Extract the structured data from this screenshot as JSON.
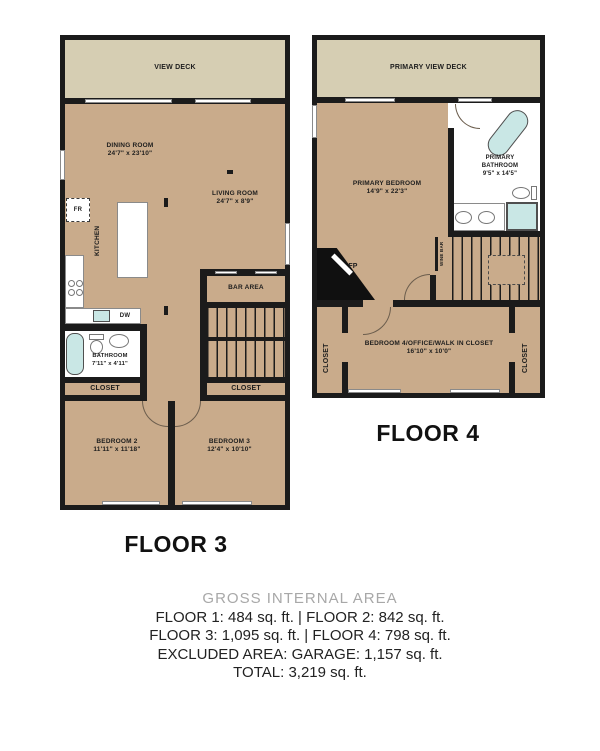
{
  "colors": {
    "wall": "#1b1b1b",
    "floor": "#c9ab8b",
    "deck": "#d6ceb3",
    "fixture_blue": "#c9e7e5",
    "muted_heading": "#a8a8a8"
  },
  "floor3": {
    "title": "FLOOR 3",
    "deck_label": "VIEW DECK",
    "dining": {
      "name": "DINING ROOM",
      "dims": "24'7\" x 23'10\""
    },
    "living": {
      "name": "LIVING ROOM",
      "dims": "24'7\" x 8'9\""
    },
    "kitchen_label": "KITCHEN",
    "fridge_label": "FR",
    "dishwasher_label": "DW",
    "bar_label": "BAR AREA",
    "bathroom": {
      "name": "BATHROOM",
      "dims": "7'11\" x 4'11\""
    },
    "closet_left_label": "CLOSET",
    "closet_right_label": "CLOSET",
    "bedroom2": {
      "name": "BEDROOM 2",
      "dims": "11'11\" x 11'18\""
    },
    "bedroom3": {
      "name": "BEDROOM 3",
      "dims": "12'4\" x 10'10\""
    }
  },
  "floor4": {
    "title": "FLOOR 4",
    "deck_label": "PRIMARY VIEW DECK",
    "primary_bedroom": {
      "name": "PRIMARY BEDROOM",
      "dims": "14'9\" x 22'3\""
    },
    "primary_bathroom": {
      "line1": "PRIMARY",
      "line2": "BATHROOM",
      "dims": "9'5\" x 14'5\""
    },
    "wine_bar_label": "WINE BAR",
    "fireplace_label": "FP",
    "bedroom4": {
      "name": "BEDROOM 4/OFFICE/WALK IN CLOSET",
      "dims": "16'10\" x 10'0\""
    },
    "closet_left_label": "CLOSET",
    "closet_right_label": "CLOSET"
  },
  "summary": {
    "heading": "GROSS INTERNAL AREA",
    "line1": "FLOOR 1: 484 sq. ft. | FLOOR 2: 842 sq. ft.",
    "line2": "FLOOR 3: 1,095 sq. ft. | FLOOR 4: 798 sq. ft.",
    "line3": "EXCLUDED AREA: GARAGE: 1,157 sq. ft.",
    "line4": "TOTAL: 3,219 sq. ft."
  }
}
